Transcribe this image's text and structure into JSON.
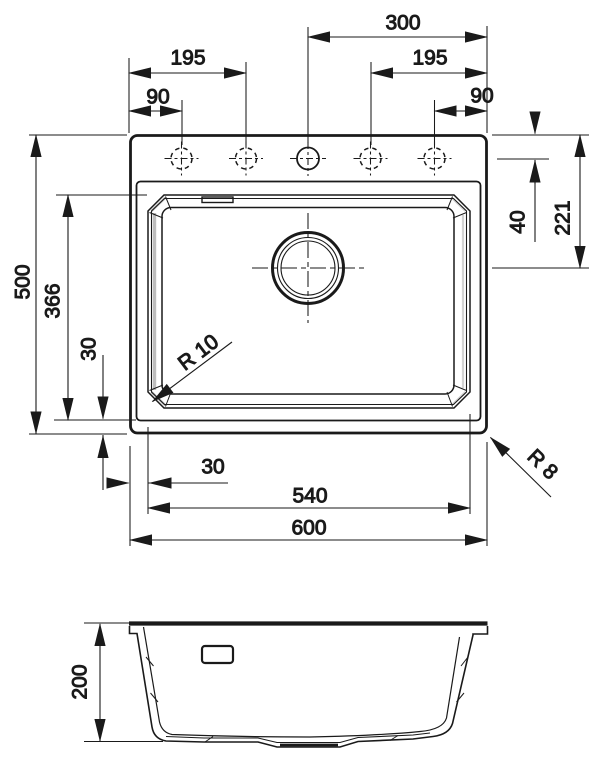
{
  "colors": {
    "line": "#1a1a1a",
    "shade": "#bdbdbd",
    "background": "#ffffff"
  },
  "top_view": {
    "dim_labels": {
      "tap_span_right": "300",
      "tap_195_left": "195",
      "tap_90_left": "90",
      "tap_195_right": "195",
      "tap_90_right": "90",
      "overall_depth": "500",
      "bowl_inner_length": "366",
      "bowl_bottom_offset": "30",
      "bowl_left_offset": "30",
      "bowl_width": "540",
      "overall_width": "600",
      "holes_from_top_edge": "40",
      "drain_from_top_edge": "221",
      "bowl_corner_radius": "R 10",
      "outer_corner_radius": "R 8"
    }
  },
  "side_view": {
    "dim_labels": {
      "overall_height": "200"
    }
  }
}
